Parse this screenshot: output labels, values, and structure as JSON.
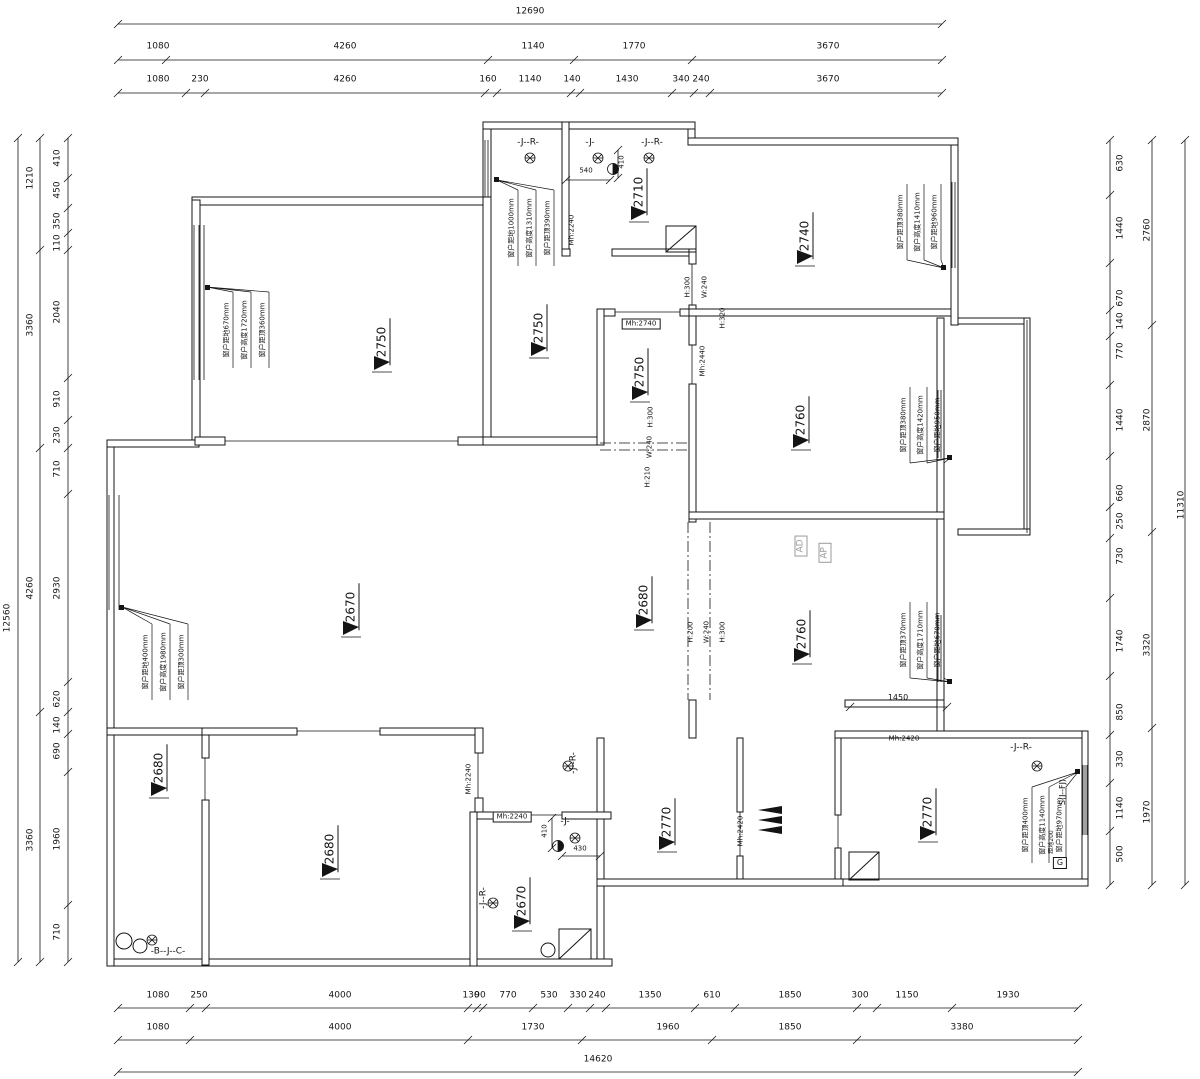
{
  "drawing_type": "residential floor plan with dimension chains, ceiling heights and window annotations",
  "colors": {
    "line": "#141414",
    "background": "#ffffff",
    "muted": "#9a9a9a"
  },
  "symbols": {
    "elevation_marker": "filled-triangle-with-underline",
    "floor_drain": "hatched-circle",
    "water_point": "half-filled-circle",
    "shower": "square-with-diagonal",
    "entry_arrow": "stacked-black-triangles"
  },
  "texts": [
    {
      "n": "dim-top-overall",
      "t": "12690",
      "x": 530,
      "y": 12
    },
    {
      "n": "dim-top",
      "t": "1080",
      "x": 158,
      "y": 47
    },
    {
      "n": "dim-top",
      "t": "4260",
      "x": 345,
      "y": 47
    },
    {
      "n": "dim-top",
      "t": "1140",
      "x": 533,
      "y": 47
    },
    {
      "n": "dim-top",
      "t": "1770",
      "x": 634,
      "y": 47
    },
    {
      "n": "dim-top",
      "t": "3670",
      "x": 828,
      "y": 47
    },
    {
      "n": "dim-top",
      "t": "1080",
      "x": 158,
      "y": 80
    },
    {
      "n": "dim-top",
      "t": "230",
      "x": 200,
      "y": 80
    },
    {
      "n": "dim-top",
      "t": "4260",
      "x": 345,
      "y": 80
    },
    {
      "n": "dim-top",
      "t": "160",
      "x": 488,
      "y": 80
    },
    {
      "n": "dim-top",
      "t": "1140",
      "x": 530,
      "y": 80
    },
    {
      "n": "dim-top",
      "t": "140",
      "x": 572,
      "y": 80
    },
    {
      "n": "dim-top",
      "t": "1430",
      "x": 627,
      "y": 80
    },
    {
      "n": "dim-top",
      "t": "340",
      "x": 681,
      "y": 80
    },
    {
      "n": "dim-top",
      "t": "240",
      "x": 701,
      "y": 80
    },
    {
      "n": "dim-top",
      "t": "3670",
      "x": 828,
      "y": 80
    },
    {
      "n": "dim-bottom",
      "t": "1080",
      "x": 158,
      "y": 996
    },
    {
      "n": "dim-bottom",
      "t": "250",
      "x": 199,
      "y": 996
    },
    {
      "n": "dim-bottom",
      "t": "4000",
      "x": 340,
      "y": 996
    },
    {
      "n": "dim-bottom",
      "t": "130",
      "x": 471,
      "y": 996
    },
    {
      "n": "dim-bottom",
      "t": "90",
      "x": 480,
      "y": 996
    },
    {
      "n": "dim-bottom",
      "t": "770",
      "x": 508,
      "y": 996
    },
    {
      "n": "dim-bottom",
      "t": "530",
      "x": 549,
      "y": 996
    },
    {
      "n": "dim-bottom",
      "t": "330",
      "x": 578,
      "y": 996
    },
    {
      "n": "dim-bottom",
      "t": "240",
      "x": 597,
      "y": 996
    },
    {
      "n": "dim-bottom",
      "t": "1350",
      "x": 650,
      "y": 996
    },
    {
      "n": "dim-bottom",
      "t": "610",
      "x": 712,
      "y": 996
    },
    {
      "n": "dim-bottom",
      "t": "1850",
      "x": 790,
      "y": 996
    },
    {
      "n": "dim-bottom",
      "t": "300",
      "x": 860,
      "y": 996
    },
    {
      "n": "dim-bottom",
      "t": "1150",
      "x": 907,
      "y": 996
    },
    {
      "n": "dim-bottom",
      "t": "1930",
      "x": 1008,
      "y": 996
    },
    {
      "n": "dim-bottom",
      "t": "1080",
      "x": 158,
      "y": 1028
    },
    {
      "n": "dim-bottom",
      "t": "4000",
      "x": 340,
      "y": 1028
    },
    {
      "n": "dim-bottom",
      "t": "1730",
      "x": 533,
      "y": 1028
    },
    {
      "n": "dim-bottom",
      "t": "1960",
      "x": 668,
      "y": 1028
    },
    {
      "n": "dim-bottom",
      "t": "1850",
      "x": 790,
      "y": 1028
    },
    {
      "n": "dim-bottom",
      "t": "3380",
      "x": 962,
      "y": 1028
    },
    {
      "n": "dim-bottom-overall",
      "t": "14620",
      "x": 598,
      "y": 1060
    },
    {
      "n": "dim-left-overall",
      "t": "12560",
      "x": 8,
      "y": 618,
      "r": -90
    },
    {
      "n": "dim-left",
      "t": "1210",
      "x": 31,
      "y": 178,
      "r": -90
    },
    {
      "n": "dim-left",
      "t": "3360",
      "x": 31,
      "y": 325,
      "r": -90
    },
    {
      "n": "dim-left",
      "t": "4260",
      "x": 31,
      "y": 588,
      "r": -90
    },
    {
      "n": "dim-left",
      "t": "3360",
      "x": 31,
      "y": 840,
      "r": -90
    },
    {
      "n": "dim-left",
      "t": "410",
      "x": 58,
      "y": 158,
      "r": -90
    },
    {
      "n": "dim-left",
      "t": "450",
      "x": 58,
      "y": 190,
      "r": -90
    },
    {
      "n": "dim-left",
      "t": "350",
      "x": 58,
      "y": 221,
      "r": -90
    },
    {
      "n": "dim-left",
      "t": "110",
      "x": 58,
      "y": 243,
      "r": -90
    },
    {
      "n": "dim-left",
      "t": "2040",
      "x": 58,
      "y": 312,
      "r": -90
    },
    {
      "n": "dim-left",
      "t": "910",
      "x": 58,
      "y": 399,
      "r": -90
    },
    {
      "n": "dim-left",
      "t": "230",
      "x": 58,
      "y": 435,
      "r": -90
    },
    {
      "n": "dim-left",
      "t": "710",
      "x": 58,
      "y": 469,
      "r": -90
    },
    {
      "n": "dim-left",
      "t": "2930",
      "x": 58,
      "y": 588,
      "r": -90
    },
    {
      "n": "dim-left",
      "t": "620",
      "x": 58,
      "y": 699,
      "r": -90
    },
    {
      "n": "dim-left",
      "t": "140",
      "x": 58,
      "y": 725,
      "r": -90
    },
    {
      "n": "dim-left",
      "t": "690",
      "x": 58,
      "y": 751,
      "r": -90
    },
    {
      "n": "dim-left",
      "t": "1960",
      "x": 58,
      "y": 839,
      "r": -90
    },
    {
      "n": "dim-left",
      "t": "710",
      "x": 58,
      "y": 932,
      "r": -90
    },
    {
      "n": "dim-right",
      "t": "630",
      "x": 1121,
      "y": 163,
      "r": -90
    },
    {
      "n": "dim-right",
      "t": "1440",
      "x": 1121,
      "y": 228,
      "r": -90
    },
    {
      "n": "dim-right",
      "t": "670",
      "x": 1121,
      "y": 298,
      "r": -90
    },
    {
      "n": "dim-right",
      "t": "140",
      "x": 1121,
      "y": 321,
      "r": -90
    },
    {
      "n": "dim-right",
      "t": "770",
      "x": 1121,
      "y": 351,
      "r": -90
    },
    {
      "n": "dim-right",
      "t": "1440",
      "x": 1121,
      "y": 420,
      "r": -90
    },
    {
      "n": "dim-right",
      "t": "660",
      "x": 1121,
      "y": 493,
      "r": -90
    },
    {
      "n": "dim-right",
      "t": "250",
      "x": 1121,
      "y": 521,
      "r": -90
    },
    {
      "n": "dim-right",
      "t": "730",
      "x": 1121,
      "y": 556,
      "r": -90
    },
    {
      "n": "dim-right",
      "t": "1740",
      "x": 1121,
      "y": 641,
      "r": -90
    },
    {
      "n": "dim-right",
      "t": "850",
      "x": 1121,
      "y": 712,
      "r": -90
    },
    {
      "n": "dim-right",
      "t": "330",
      "x": 1121,
      "y": 759,
      "r": -90
    },
    {
      "n": "dim-right",
      "t": "1140",
      "x": 1121,
      "y": 808,
      "r": -90
    },
    {
      "n": "dim-right",
      "t": "500",
      "x": 1121,
      "y": 854,
      "r": -90
    },
    {
      "n": "dim-right",
      "t": "2760",
      "x": 1148,
      "y": 230,
      "r": -90
    },
    {
      "n": "dim-right",
      "t": "2870",
      "x": 1148,
      "y": 420,
      "r": -90
    },
    {
      "n": "dim-right",
      "t": "3320",
      "x": 1148,
      "y": 645,
      "r": -90
    },
    {
      "n": "dim-right",
      "t": "1970",
      "x": 1148,
      "y": 812,
      "r": -90
    },
    {
      "n": "dim-right-overall",
      "t": "11310",
      "x": 1182,
      "y": 505,
      "r": -90
    },
    {
      "n": "ceiling-elevation",
      "t": "2750",
      "x": 383,
      "y": 342,
      "r": -90,
      "s": 12,
      "cls": "elev"
    },
    {
      "n": "ceiling-elevation",
      "t": "2750",
      "x": 540,
      "y": 328,
      "r": -90,
      "s": 12,
      "cls": "elev"
    },
    {
      "n": "ceiling-elevation",
      "t": "2710",
      "x": 640,
      "y": 192,
      "r": -90,
      "s": 12,
      "cls": "elev"
    },
    {
      "n": "ceiling-elevation",
      "t": "2740",
      "x": 806,
      "y": 236,
      "r": -90,
      "s": 12,
      "cls": "elev"
    },
    {
      "n": "ceiling-elevation",
      "t": "2750",
      "x": 641,
      "y": 372,
      "r": -90,
      "s": 12,
      "cls": "elev"
    },
    {
      "n": "ceiling-elevation",
      "t": "2760",
      "x": 802,
      "y": 420,
      "r": -90,
      "s": 12,
      "cls": "elev"
    },
    {
      "n": "ceiling-elevation",
      "t": "2670",
      "x": 352,
      "y": 607,
      "r": -90,
      "s": 12,
      "cls": "elev"
    },
    {
      "n": "ceiling-elevation",
      "t": "2680",
      "x": 645,
      "y": 600,
      "r": -90,
      "s": 12,
      "cls": "elev"
    },
    {
      "n": "ceiling-elevation",
      "t": "2760",
      "x": 803,
      "y": 634,
      "r": -90,
      "s": 12,
      "cls": "elev"
    },
    {
      "n": "ceiling-elevation",
      "t": "2680",
      "x": 160,
      "y": 768,
      "r": -90,
      "s": 12,
      "cls": "elev"
    },
    {
      "n": "ceiling-elevation",
      "t": "2680",
      "x": 331,
      "y": 849,
      "r": -90,
      "s": 12,
      "cls": "elev"
    },
    {
      "n": "ceiling-elevation",
      "t": "2670",
      "x": 523,
      "y": 901,
      "r": -90,
      "s": 12,
      "cls": "elev"
    },
    {
      "n": "ceiling-elevation",
      "t": "2770",
      "x": 668,
      "y": 822,
      "r": -90,
      "s": 12,
      "cls": "elev"
    },
    {
      "n": "ceiling-elevation",
      "t": "2770",
      "x": 929,
      "y": 812,
      "r": -90,
      "s": 12,
      "cls": "elev"
    },
    {
      "n": "door-height",
      "t": "Mh:2240",
      "x": 572,
      "y": 230,
      "r": -90,
      "s": 7
    },
    {
      "n": "door-height",
      "t": "Mh:2740",
      "x": 641,
      "y": 324,
      "s": 7,
      "cls": "box"
    },
    {
      "n": "door-height",
      "t": "Mh:2440",
      "x": 703,
      "y": 361,
      "r": -90,
      "s": 7
    },
    {
      "n": "door-height",
      "t": "Mh:2420",
      "x": 904,
      "y": 739,
      "s": 7
    },
    {
      "n": "door-height",
      "t": "Mh:2420",
      "x": 741,
      "y": 831,
      "r": -90,
      "s": 7
    },
    {
      "n": "door-height",
      "t": "Mh:2240",
      "x": 469,
      "y": 779,
      "r": -90,
      "s": 7
    },
    {
      "n": "door-height",
      "t": "Mh:2240",
      "x": 512,
      "y": 817,
      "s": 7,
      "cls": "box"
    },
    {
      "n": "beam-note",
      "t": "H:300",
      "x": 688,
      "y": 287,
      "r": -90,
      "s": 7
    },
    {
      "n": "beam-note",
      "t": "W:240",
      "x": 705,
      "y": 287,
      "r": -90,
      "s": 7
    },
    {
      "n": "beam-note",
      "t": "H:320",
      "x": 723,
      "y": 318,
      "r": -90,
      "s": 7
    },
    {
      "n": "beam-note",
      "t": "H:300",
      "x": 651,
      "y": 417,
      "r": -90,
      "s": 7
    },
    {
      "n": "beam-note",
      "t": "W:240",
      "x": 650,
      "y": 447,
      "r": -90,
      "s": 7
    },
    {
      "n": "beam-note",
      "t": "H:210",
      "x": 648,
      "y": 477,
      "r": -90,
      "s": 7
    },
    {
      "n": "beam-note",
      "t": "H:200",
      "x": 691,
      "y": 632,
      "r": -90,
      "s": 7
    },
    {
      "n": "beam-note",
      "t": "W:240",
      "x": 707,
      "y": 632,
      "r": -90,
      "s": 7
    },
    {
      "n": "beam-note",
      "t": "H:300",
      "x": 723,
      "y": 632,
      "r": -90,
      "s": 7
    },
    {
      "n": "window-note",
      "t": "窗户距地670mm",
      "x": 227,
      "y": 330,
      "r": -90,
      "s": 7
    },
    {
      "n": "window-note",
      "t": "窗户高度1720mm",
      "x": 245,
      "y": 330,
      "r": -90,
      "s": 7
    },
    {
      "n": "window-note",
      "t": "窗户距顶360mm",
      "x": 263,
      "y": 330,
      "r": -90,
      "s": 7
    },
    {
      "n": "window-note",
      "t": "窗户距地400mm",
      "x": 146,
      "y": 662,
      "r": -90,
      "s": 7
    },
    {
      "n": "window-note",
      "t": "窗户高度1980mm",
      "x": 164,
      "y": 662,
      "r": -90,
      "s": 7
    },
    {
      "n": "window-note",
      "t": "窗户距顶300mm",
      "x": 182,
      "y": 662,
      "r": -90,
      "s": 7
    },
    {
      "n": "window-note",
      "t": "窗户距地1000mm",
      "x": 512,
      "y": 228,
      "r": -90,
      "s": 7
    },
    {
      "n": "window-note",
      "t": "窗户高度1310mm",
      "x": 530,
      "y": 228,
      "r": -90,
      "s": 7
    },
    {
      "n": "window-note",
      "t": "窗户距顶390mm",
      "x": 548,
      "y": 228,
      "r": -90,
      "s": 7
    },
    {
      "n": "window-note",
      "t": "窗户距顶380mm",
      "x": 901,
      "y": 222,
      "r": -90,
      "s": 7
    },
    {
      "n": "window-note",
      "t": "窗户高度1410mm",
      "x": 918,
      "y": 222,
      "r": -90,
      "s": 7
    },
    {
      "n": "window-note",
      "t": "窗户距地960mm",
      "x": 935,
      "y": 222,
      "r": -90,
      "s": 7
    },
    {
      "n": "window-note",
      "t": "窗户距顶380mm",
      "x": 904,
      "y": 425,
      "r": -90,
      "s": 7
    },
    {
      "n": "window-note",
      "t": "窗户高度1420mm",
      "x": 921,
      "y": 425,
      "r": -90,
      "s": 7
    },
    {
      "n": "window-note",
      "t": "窗户距地950mm",
      "x": 938,
      "y": 425,
      "r": -90,
      "s": 7
    },
    {
      "n": "window-note",
      "t": "窗户距顶370mm",
      "x": 904,
      "y": 640,
      "r": -90,
      "s": 7
    },
    {
      "n": "window-note",
      "t": "窗户高度1710mm",
      "x": 921,
      "y": 640,
      "r": -90,
      "s": 7
    },
    {
      "n": "window-note",
      "t": "窗户距地670mm",
      "x": 938,
      "y": 640,
      "r": -90,
      "s": 7
    },
    {
      "n": "window-note",
      "t": "窗户距顶400mm",
      "x": 1026,
      "y": 825,
      "r": -90,
      "s": 7
    },
    {
      "n": "window-note",
      "t": "窗户高度1140mm",
      "x": 1043,
      "y": 825,
      "r": -90,
      "s": 7
    },
    {
      "n": "window-note",
      "t": "窗户距地970mm",
      "x": 1060,
      "y": 825,
      "r": -90,
      "s": 7
    },
    {
      "n": "plumbing-tag",
      "t": "-J--R-",
      "x": 528,
      "y": 143,
      "s": 9
    },
    {
      "n": "plumbing-tag",
      "t": "-J-",
      "x": 590,
      "y": 143,
      "s": 9
    },
    {
      "n": "plumbing-tag",
      "t": "-J--R-",
      "x": 652,
      "y": 143,
      "s": 9
    },
    {
      "n": "plumbing-tag",
      "t": "-J--R-",
      "x": 574,
      "y": 763,
      "r": -90,
      "s": 9
    },
    {
      "n": "plumbing-tag",
      "t": "-J-",
      "x": 565,
      "y": 822,
      "s": 9
    },
    {
      "n": "plumbing-tag",
      "t": "-J--R-",
      "x": 484,
      "y": 898,
      "r": -90,
      "s": 9
    },
    {
      "n": "plumbing-tag",
      "t": "-J--R-",
      "x": 1021,
      "y": 748,
      "s": 9
    },
    {
      "n": "plumbing-tag",
      "t": "-B--J--C-",
      "x": 168,
      "y": 952,
      "s": 9
    },
    {
      "n": "dim-small",
      "t": "540",
      "x": 586,
      "y": 171,
      "s": 7
    },
    {
      "n": "dim-small",
      "t": "410",
      "x": 622,
      "y": 162,
      "r": -90,
      "s": 7
    },
    {
      "n": "dim-small",
      "t": "410",
      "x": 545,
      "y": 831,
      "r": -90,
      "s": 7
    },
    {
      "n": "dim-small",
      "t": "430",
      "x": 580,
      "y": 849,
      "s": 7
    },
    {
      "n": "dim-small",
      "t": "1450",
      "x": 898,
      "y": 698,
      "s": 8
    },
    {
      "n": "air-duct-tag",
      "t": "AD",
      "x": 801,
      "y": 546,
      "r": -90,
      "s": 9,
      "cls": "box grey"
    },
    {
      "n": "air-duct-tag",
      "t": "AP",
      "x": 825,
      "y": 553,
      "r": -90,
      "s": 9,
      "cls": "box grey"
    },
    {
      "n": "stack-tag",
      "t": "S(J--FJ)",
      "x": 1063,
      "y": 792,
      "r": -90,
      "s": 8
    },
    {
      "n": "gas-note",
      "t": "距地200",
      "x": 1052,
      "y": 842,
      "r": -90,
      "s": 6
    },
    {
      "n": "gas-meter-tag",
      "t": "G",
      "x": 1060,
      "y": 863,
      "s": 8,
      "cls": "box"
    }
  ],
  "dim_chains": [
    {
      "dir": "h",
      "at": 24,
      "from": 118,
      "to": 942,
      "ticks": [
        118,
        942
      ]
    },
    {
      "dir": "h",
      "at": 60,
      "from": 118,
      "to": 942,
      "ticks": [
        118,
        166,
        488,
        574,
        692,
        942
      ]
    },
    {
      "dir": "h",
      "at": 93,
      "from": 118,
      "to": 942,
      "ticks": [
        118,
        186,
        205,
        485,
        497,
        571,
        580,
        672,
        694,
        710,
        942
      ]
    },
    {
      "dir": "h",
      "at": 1008,
      "from": 118,
      "to": 1078,
      "ticks": [
        118,
        190,
        206,
        468,
        477,
        483,
        533,
        568,
        590,
        606,
        695,
        735,
        857,
        877,
        952,
        1078
      ]
    },
    {
      "dir": "h",
      "at": 1040,
      "from": 118,
      "to": 1078,
      "ticks": [
        118,
        190,
        468,
        582,
        712,
        857,
        1078
      ]
    },
    {
      "dir": "h",
      "at": 1072,
      "from": 118,
      "to": 1078,
      "ticks": [
        118,
        1078
      ]
    },
    {
      "dir": "v",
      "at": 18,
      "from": 138,
      "to": 962,
      "ticks": [
        138,
        962
      ]
    },
    {
      "dir": "v",
      "at": 40,
      "from": 138,
      "to": 962,
      "ticks": [
        138,
        250,
        448,
        712,
        962
      ]
    },
    {
      "dir": "v",
      "at": 68,
      "from": 138,
      "to": 962,
      "ticks": [
        138,
        178,
        208,
        233,
        250,
        378,
        420,
        448,
        494,
        682,
        712,
        734,
        772,
        905,
        962
      ]
    },
    {
      "dir": "v",
      "at": 1110,
      "from": 140,
      "to": 885,
      "ticks": [
        140,
        195,
        263,
        310,
        336,
        385,
        456,
        507,
        538,
        598,
        676,
        735,
        783,
        831,
        885
      ]
    },
    {
      "dir": "v",
      "at": 1152,
      "from": 140,
      "to": 885,
      "ticks": [
        140,
        325,
        532,
        728,
        885
      ]
    },
    {
      "dir": "v",
      "at": 1185,
      "from": 140,
      "to": 885,
      "ticks": [
        140,
        885
      ]
    },
    {
      "dir": "h",
      "at": 180,
      "from": 566,
      "to": 610,
      "ticks": [
        566,
        610
      ]
    },
    {
      "dir": "v",
      "at": 618,
      "from": 150,
      "to": 178,
      "ticks": [
        150,
        178
      ]
    },
    {
      "dir": "v",
      "at": 552,
      "from": 818,
      "to": 848,
      "ticks": [
        818,
        848
      ]
    },
    {
      "dir": "h",
      "at": 856,
      "from": 562,
      "to": 600,
      "ticks": [
        562,
        600
      ]
    },
    {
      "dir": "h",
      "at": 707,
      "from": 850,
      "to": 947,
      "ticks": [
        850,
        947
      ]
    }
  ]
}
